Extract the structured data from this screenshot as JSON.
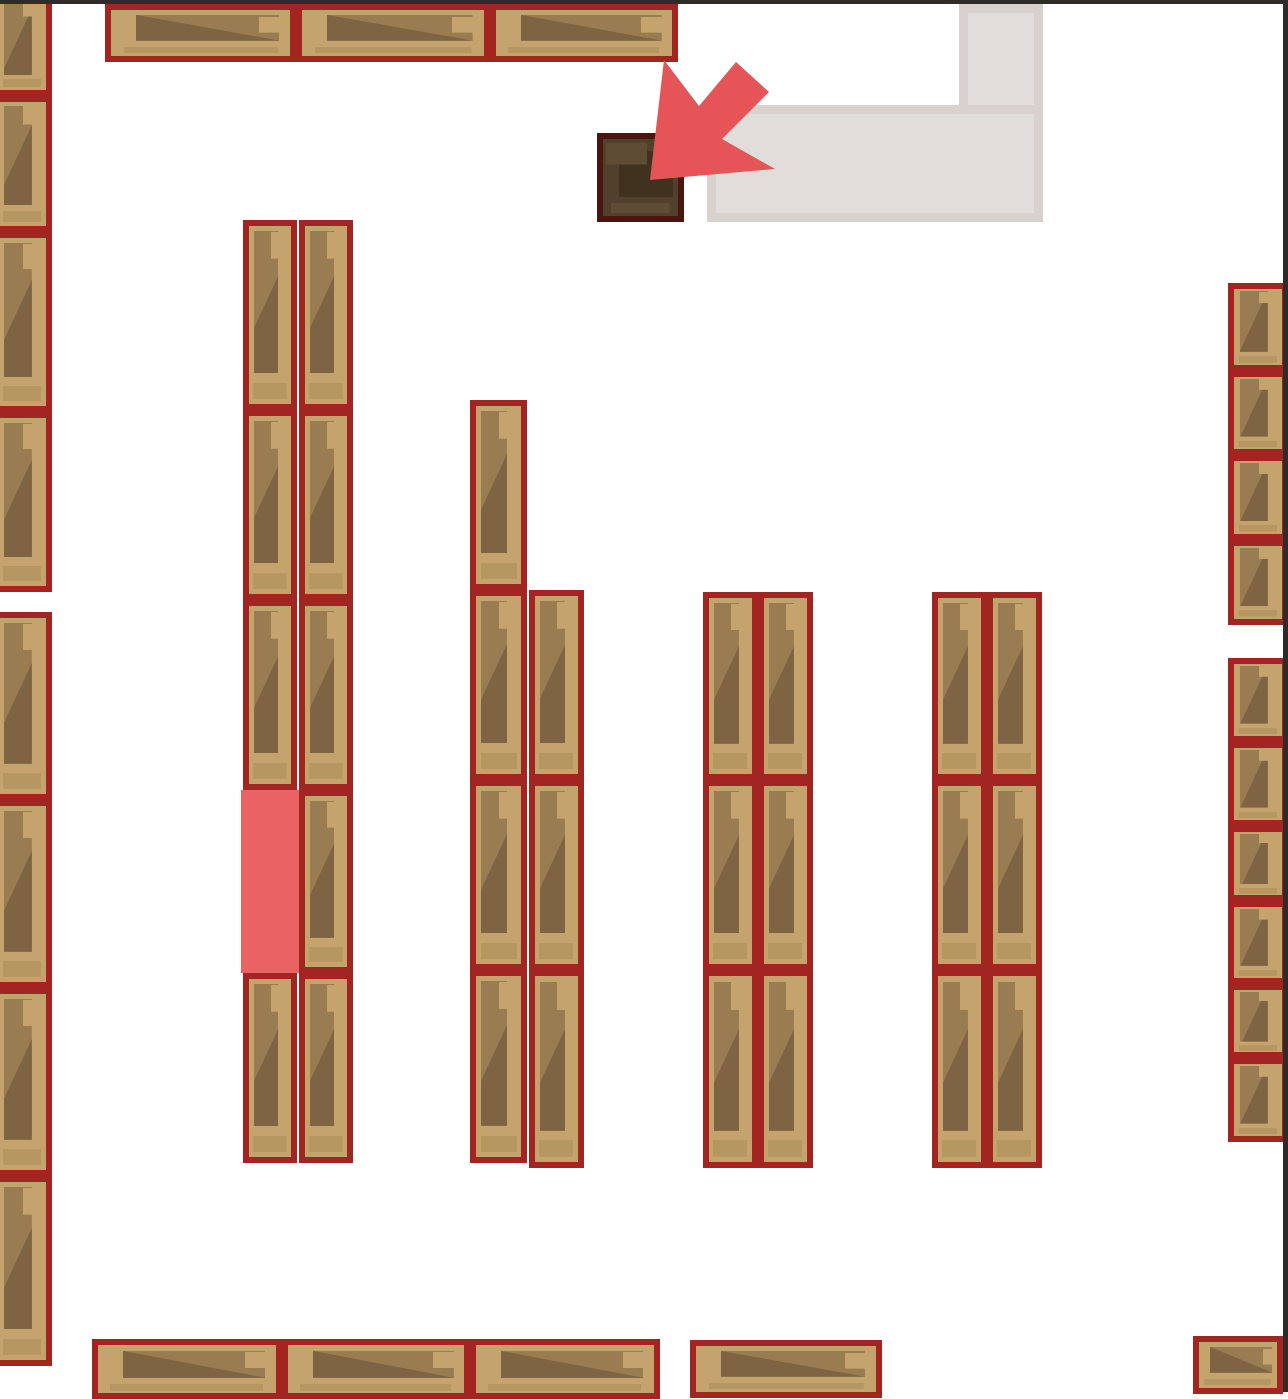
{
  "palette": {
    "floor": "#ffffff",
    "map_edge": "#2e2b29",
    "shelf_border": "#a22521",
    "wood_base": "#c4a46c",
    "wood_mid": "#9a7c52",
    "wood_dark": "#7f6443",
    "wood_strip": "#b5975f",
    "desk_border": "#4a1610",
    "desk_base": "#51402c",
    "desk_dark": "#40321f",
    "desk_light": "#5f4c35",
    "corridor_base": "#d9d1ce",
    "corridor_inner": "#e1dddb",
    "highlight": "#e96363",
    "arrow": "#e55456"
  },
  "scene": {
    "canvas": {
      "w": 1288,
      "h": 1392
    },
    "edges": {
      "top": [
        0,
        0,
        1288,
        4
      ],
      "right": [
        1283,
        0,
        5,
        1392
      ]
    },
    "corridor": [
      [
        959,
        4,
        84,
        218
      ],
      [
        707,
        105,
        336,
        117
      ]
    ],
    "desk": [
      597,
      133,
      87,
      89
    ],
    "highlight_cell": [
      241,
      790,
      58,
      183
    ],
    "arrow_points": [
      [
        650,
        180
      ],
      [
        664,
        60
      ],
      [
        699,
        106
      ],
      [
        736,
        62
      ],
      [
        769,
        92
      ],
      [
        722,
        139
      ],
      [
        775,
        169
      ]
    ],
    "shelves_v": [
      [
        -8,
        -6,
        60,
        102
      ],
      [
        -8,
        96,
        60,
        136
      ],
      [
        -8,
        232,
        60,
        180
      ],
      [
        -8,
        412,
        60,
        180
      ],
      [
        -8,
        612,
        60,
        188
      ],
      [
        -8,
        800,
        60,
        188
      ],
      [
        -8,
        988,
        60,
        188
      ],
      [
        -8,
        1176,
        60,
        190
      ],
      [
        243,
        220,
        54,
        190
      ],
      [
        243,
        410,
        54,
        190
      ],
      [
        243,
        600,
        54,
        190
      ],
      [
        243,
        973,
        54,
        190
      ],
      [
        299,
        220,
        54,
        190
      ],
      [
        299,
        410,
        54,
        190
      ],
      [
        299,
        600,
        54,
        190
      ],
      [
        299,
        790,
        54,
        183
      ],
      [
        299,
        973,
        54,
        190
      ],
      [
        470,
        400,
        57,
        190
      ],
      [
        470,
        590,
        57,
        190
      ],
      [
        470,
        780,
        57,
        190
      ],
      [
        470,
        970,
        57,
        193
      ],
      [
        529,
        590,
        55,
        190
      ],
      [
        529,
        780,
        55,
        190
      ],
      [
        529,
        970,
        55,
        198
      ],
      [
        703,
        592,
        55,
        188
      ],
      [
        703,
        780,
        55,
        190
      ],
      [
        703,
        970,
        55,
        198
      ],
      [
        758,
        592,
        55,
        188
      ],
      [
        758,
        780,
        55,
        190
      ],
      [
        758,
        970,
        55,
        198
      ],
      [
        932,
        592,
        55,
        188
      ],
      [
        932,
        780,
        55,
        190
      ],
      [
        932,
        970,
        55,
        198
      ],
      [
        987,
        592,
        55,
        188
      ],
      [
        987,
        780,
        55,
        190
      ],
      [
        987,
        970,
        55,
        198
      ],
      [
        1228,
        283,
        60,
        88
      ],
      [
        1228,
        371,
        60,
        84
      ],
      [
        1228,
        455,
        60,
        85
      ],
      [
        1228,
        540,
        60,
        85
      ],
      [
        1228,
        658,
        60,
        84
      ],
      [
        1228,
        742,
        60,
        84
      ],
      [
        1228,
        826,
        60,
        75
      ],
      [
        1228,
        901,
        60,
        83
      ],
      [
        1228,
        984,
        60,
        74
      ],
      [
        1228,
        1058,
        60,
        84
      ]
    ],
    "shelves_h": [
      [
        105,
        4,
        191,
        58
      ],
      [
        296,
        4,
        194,
        58
      ],
      [
        490,
        4,
        188,
        58
      ],
      [
        92,
        1339,
        190,
        60
      ],
      [
        282,
        1339,
        188,
        60
      ],
      [
        470,
        1339,
        190,
        60
      ],
      [
        690,
        1340,
        192,
        58
      ],
      [
        1193,
        1336,
        90,
        58
      ]
    ]
  }
}
